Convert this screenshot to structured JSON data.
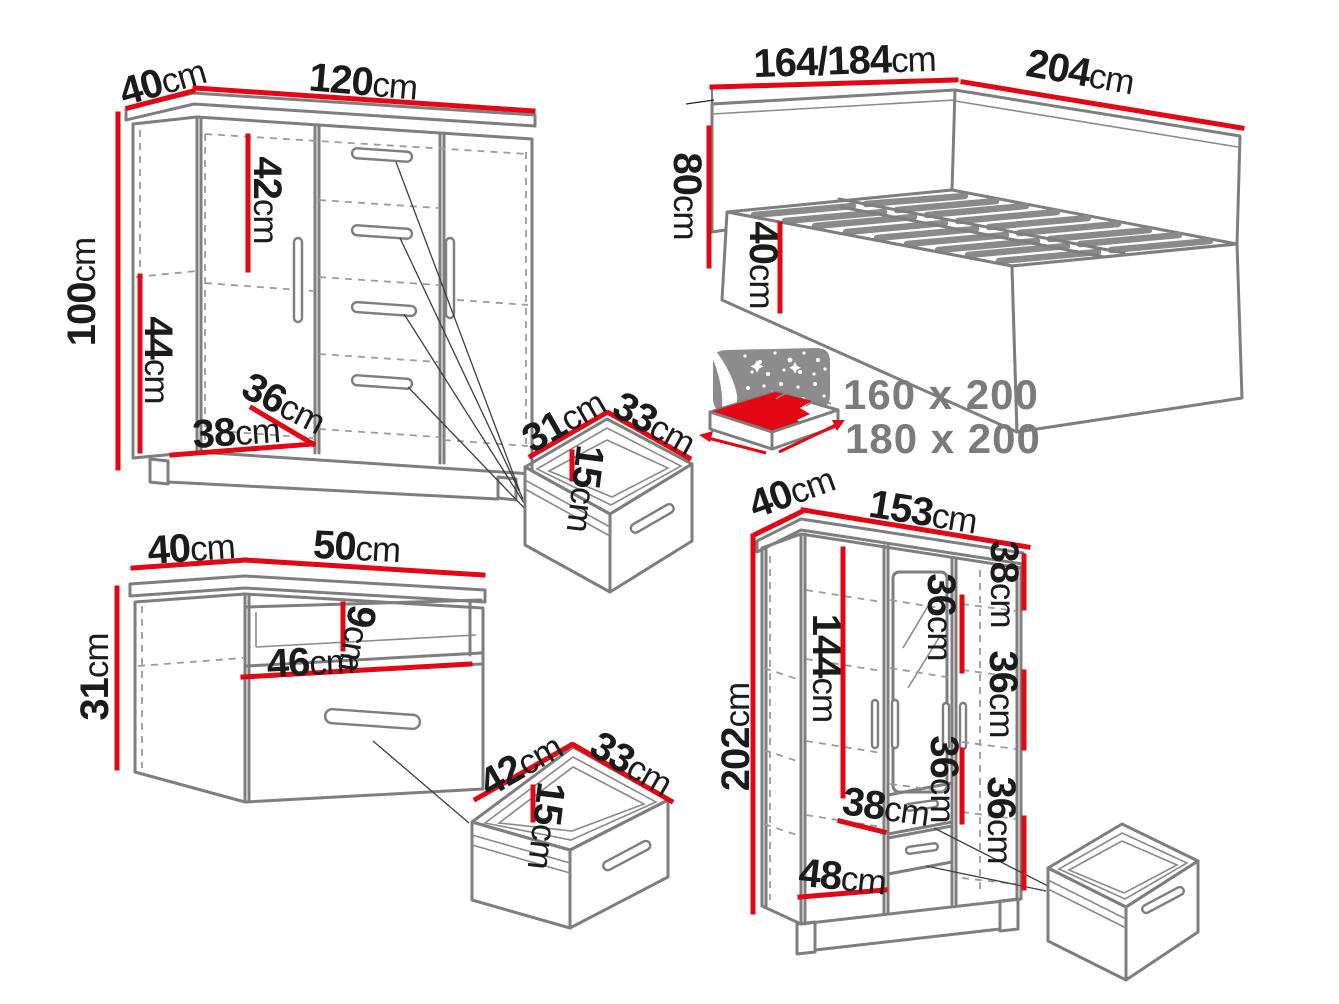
{
  "colors": {
    "dimension_red": "#e30613",
    "outline_gray": "#7e7e7e",
    "label_dark": "#1b1b1b",
    "muted_gray": "#7b7b7b"
  },
  "furniture": {
    "chest_of_drawers": {
      "depth": {
        "value": "40",
        "unit": "cm"
      },
      "width": {
        "value": "120",
        "unit": "cm"
      },
      "height": {
        "value": "100",
        "unit": "cm"
      },
      "upper_compartment_height": {
        "value": "42",
        "unit": "cm"
      },
      "lower_compartment_height": {
        "value": "44",
        "unit": "cm"
      },
      "interior_depth": {
        "value": "36",
        "unit": "cm"
      },
      "interior_width": {
        "value": "38",
        "unit": "cm"
      }
    },
    "bed": {
      "width": {
        "value": "164/184",
        "unit": "cm"
      },
      "length": {
        "value": "204",
        "unit": "cm"
      },
      "headboard_height": {
        "value": "80",
        "unit": "cm"
      },
      "frame_height": {
        "value": "40",
        "unit": "cm"
      },
      "mattress_sizes": [
        "160 x 200",
        "180 x 200"
      ]
    },
    "small_drawer": {
      "width": {
        "value": "31",
        "unit": "cm"
      },
      "depth": {
        "value": "33",
        "unit": "cm"
      },
      "height": {
        "value": "15",
        "unit": "cm"
      }
    },
    "nightstand": {
      "depth": {
        "value": "40",
        "unit": "cm"
      },
      "width": {
        "value": "50",
        "unit": "cm"
      },
      "height": {
        "value": "31",
        "unit": "cm"
      },
      "niche_height": {
        "value": "9",
        "unit": "cm"
      },
      "interior_width": {
        "value": "46",
        "unit": "cm"
      }
    },
    "large_drawer": {
      "width": {
        "value": "42",
        "unit": "cm"
      },
      "depth": {
        "value": "33",
        "unit": "cm"
      },
      "height": {
        "value": "15",
        "unit": "cm"
      }
    },
    "wardrobe": {
      "depth": {
        "value": "40",
        "unit": "cm"
      },
      "width": {
        "value": "153",
        "unit": "cm"
      },
      "height": {
        "value": "202",
        "unit": "cm"
      },
      "hanging_section_height": {
        "value": "144",
        "unit": "cm"
      },
      "top_section_height": {
        "value": "38",
        "unit": "cm"
      },
      "shelf_spacing": {
        "value": "36",
        "unit": "cm"
      },
      "interior_width": {
        "value": "38",
        "unit": "cm"
      },
      "bottom_interior_width": {
        "value": "48",
        "unit": "cm"
      }
    }
  }
}
